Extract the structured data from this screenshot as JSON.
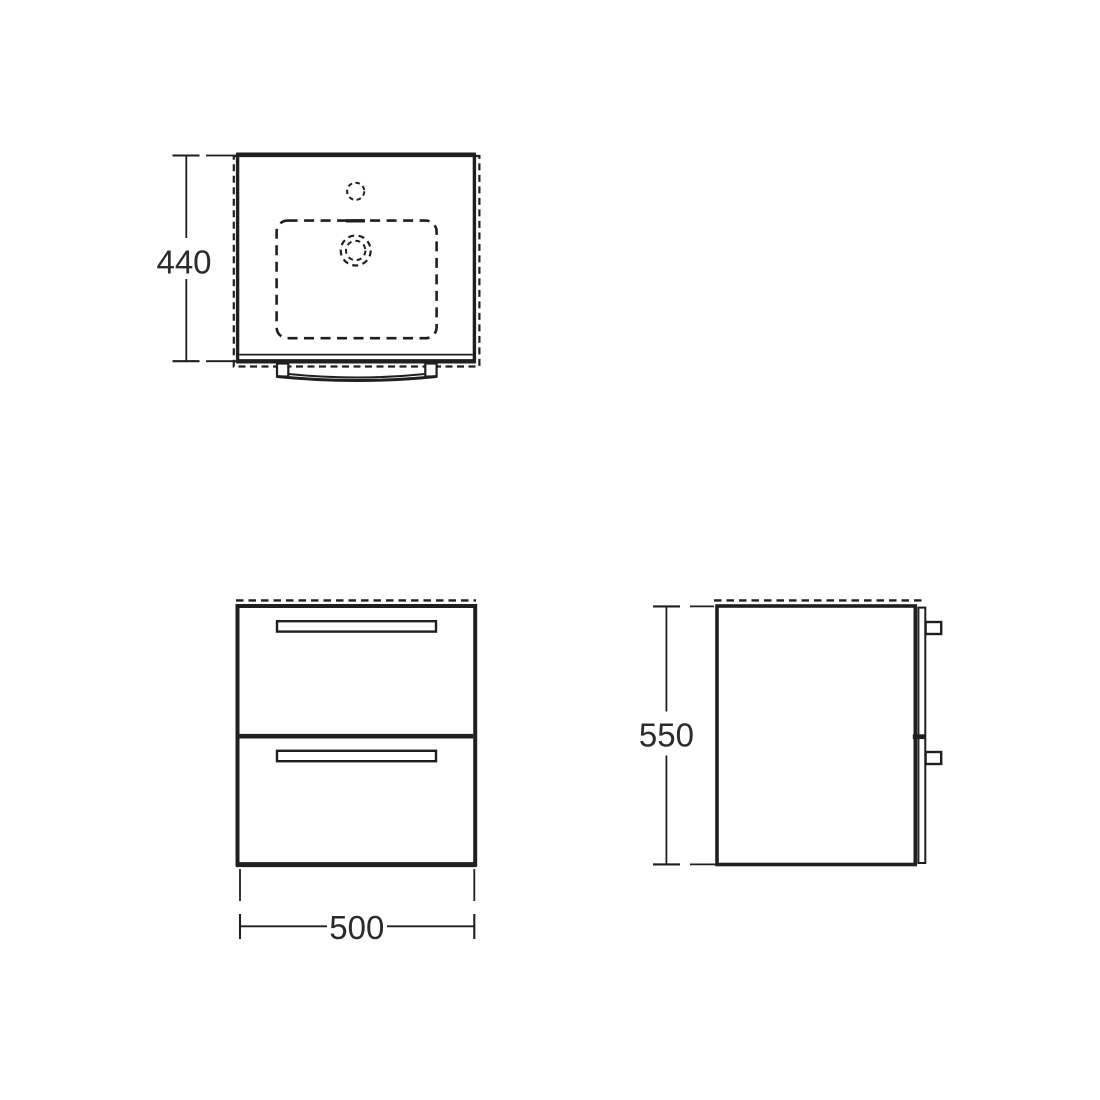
{
  "colors": {
    "line_color": "#1f1f1f",
    "text_color": "#2b2b2b",
    "background": "#ffffff"
  },
  "views": {
    "plan": {
      "dimension_label": "440"
    },
    "front": {
      "dimension_label": "500"
    },
    "side": {
      "dimension_label": "550"
    }
  }
}
